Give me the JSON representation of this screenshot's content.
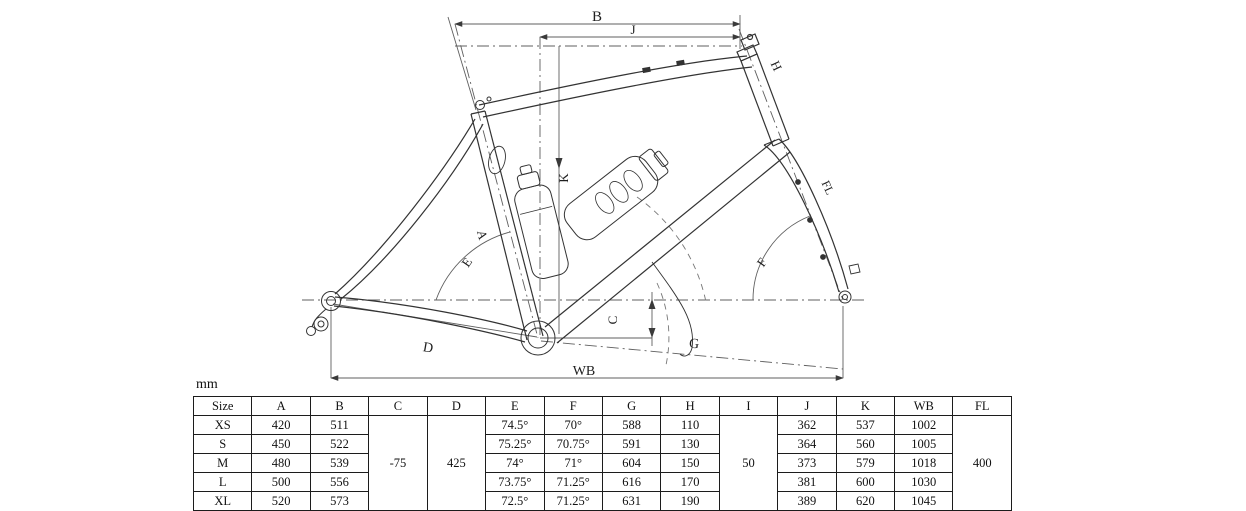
{
  "sheet": {
    "title": "bike-frame-geometry-drawing",
    "units_label": "mm",
    "line_color": "#3a3a3a",
    "construction_color": "#6a6a6a",
    "background": "#ffffff"
  },
  "diagram": {
    "labels": {
      "top_tube": "B",
      "reach": "J",
      "head_tube": "H",
      "stack": "K",
      "seat_tube": "A",
      "seat_tube_angle": "E",
      "head_tube_angle": "F",
      "bb_drop": "C",
      "chainstay": "D",
      "front_center": "G",
      "wheelbase": "WB",
      "fork_length": "FL"
    }
  },
  "table": {
    "columns": [
      "Size",
      "A",
      "B",
      "C",
      "D",
      "E",
      "F",
      "G",
      "H",
      "I",
      "J",
      "K",
      "WB",
      "FL"
    ],
    "merged": {
      "C": "-75",
      "D": "425",
      "I": "50",
      "FL": "400"
    },
    "rows": [
      {
        "Size": "XS",
        "A": "420",
        "B": "511",
        "E": "74.5°",
        "F": "70°",
        "G": "588",
        "H": "110",
        "J": "362",
        "K": "537",
        "WB": "1002"
      },
      {
        "Size": "S",
        "A": "450",
        "B": "522",
        "E": "75.25°",
        "F": "70.75°",
        "G": "591",
        "H": "130",
        "J": "364",
        "K": "560",
        "WB": "1005"
      },
      {
        "Size": "M",
        "A": "480",
        "B": "539",
        "E": "74°",
        "F": "71°",
        "G": "604",
        "H": "150",
        "J": "373",
        "K": "579",
        "WB": "1018"
      },
      {
        "Size": "L",
        "A": "500",
        "B": "556",
        "E": "73.75°",
        "F": "71.25°",
        "G": "616",
        "H": "170",
        "J": "381",
        "K": "600",
        "WB": "1030"
      },
      {
        "Size": "XL",
        "A": "520",
        "B": "573",
        "E": "72.5°",
        "F": "71.25°",
        "G": "631",
        "H": "190",
        "J": "389",
        "K": "620",
        "WB": "1045"
      }
    ]
  }
}
